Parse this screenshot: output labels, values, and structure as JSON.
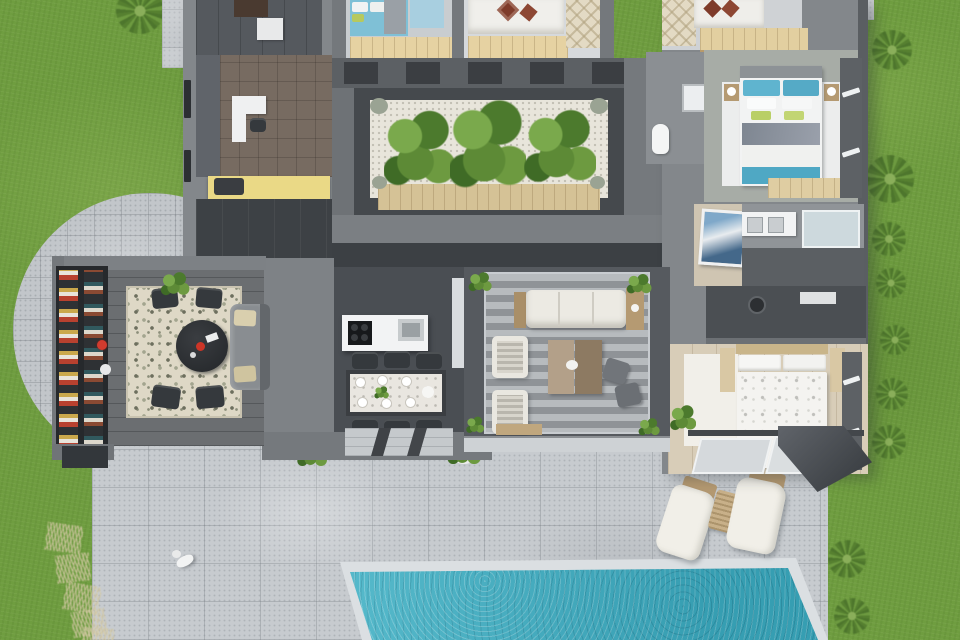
{
  "scene": {
    "description": "Top-down 3D architectural rendering of a single-story modern villa: furnished rooms around an interior planted courtyard, curved stone terrace, large paved patio with sun loungers and a turquoise swimming pool, surrounded by lawn",
    "view": "top-down 3D floor plan",
    "visible_text": "none"
  },
  "palette": {
    "grass": "#6f9d40",
    "patio": "#c7cbcf",
    "walkway": "#c9ccd0",
    "pool_water": "#3fb0c4",
    "pool_coping": "#dbdfe2",
    "wall": "#83878b",
    "wall_dark": "#3c4044",
    "floor_dark": "#4a4e53",
    "floor_entry": "#3d4145",
    "gravel": "#e8e5db",
    "wood_light": "#e6d2a2",
    "wood_mid": "#b59a72",
    "plant_green": "#5d8a36",
    "plant_green_light": "#7aa94c",
    "bed_blue": "#7fc0d6",
    "bed_teal": "#5fb4cf",
    "pillow_rust": "#7e3b2a",
    "bench_yellow": "#ead986",
    "sofa_white": "#eceae3",
    "sofa_gray": "#898d91",
    "rug_cream": "#ded8c6",
    "shelf_dark": "#26292c",
    "accent_red": "#d23b2e"
  },
  "rooms": [
    {
      "name": "entry-hall",
      "floor": "dark tile"
    },
    {
      "name": "study",
      "furniture": [
        "white desk",
        "dark chair",
        "yellow bench"
      ]
    },
    {
      "name": "bedroom-top-left",
      "furniture": [
        "blue bed",
        "window bench"
      ]
    },
    {
      "name": "bedroom-top-middle",
      "furniture": [
        "white bed",
        "rust diamond pillows",
        "window bench"
      ]
    },
    {
      "name": "bedroom-top-right",
      "furniture": [
        "white bed",
        "rust diamond pillows",
        "checkered rug"
      ]
    },
    {
      "name": "courtyard-atrium",
      "features": [
        "white gravel",
        "three green planters",
        "wood planter boxes"
      ]
    },
    {
      "name": "bathroom-top",
      "furniture": [
        "toilet",
        "shower"
      ]
    },
    {
      "name": "bedroom-teal",
      "furniture": [
        "teal bed",
        "nightstands with lamps",
        "white rug",
        "wood bench"
      ]
    },
    {
      "name": "laundry",
      "furniture": [
        "leaning blue artwork"
      ]
    },
    {
      "name": "bathroom-right",
      "furniture": [
        "double vanity",
        "glass shower"
      ]
    },
    {
      "name": "wardrobe-closet",
      "furniture": [
        "dark wardrobe"
      ]
    },
    {
      "name": "master-bedroom",
      "furniture": [
        "white floral bed",
        "white rug",
        "plant",
        "glass doors"
      ]
    },
    {
      "name": "kitchen",
      "furniture": [
        "white island with cooktop and sink"
      ]
    },
    {
      "name": "dining-area",
      "furniture": [
        "table with 6 place settings",
        "6 dark chairs",
        "step mat"
      ]
    },
    {
      "name": "living-room",
      "furniture": [
        "striped rug",
        "long white sofa",
        "2 striped armchairs",
        "two-tone coffee table",
        "2 gray poufs"
      ]
    },
    {
      "name": "library-dining-room",
      "furniture": [
        "bookshelf with colorful books",
        "floral rug",
        "dark oval table",
        "4 dark chairs",
        "gray sofa",
        "plant"
      ]
    }
  ],
  "outdoor": {
    "features": [
      "top-left walkway",
      "curved stone terrace",
      "large paved patio",
      "swimming pool",
      "lawn",
      "palm shrubs",
      "dry grass tufts",
      "small white dog"
    ],
    "sun_loungers": 2,
    "wicker_side_table": 1,
    "palm_shrubs": 9,
    "pool_shape": "rectangular, perspective-skewed, bottom edge cropped"
  }
}
